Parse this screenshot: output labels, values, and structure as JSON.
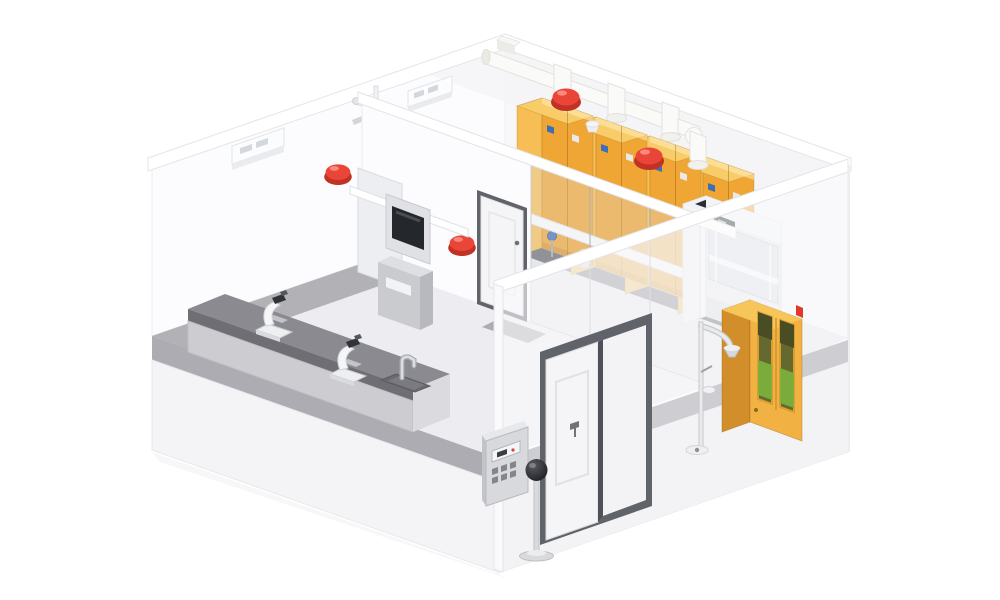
{
  "illustration": {
    "kind": "3d-isometric-cutaway-render",
    "subject": "laboratory room with ventilated hazardous-material safety cabinets",
    "background": "#ffffff",
    "objects": [
      {
        "id": "room-shell",
        "label": "White cutaway room shell with translucent walls and gray floor"
      },
      {
        "id": "ventilation-units",
        "label": "Wall-mounted white ventilation units",
        "count": 2
      },
      {
        "id": "alarm-beacons",
        "label": "Red dome alarm beacons",
        "count": 4
      },
      {
        "id": "gas-cabinet-row",
        "label": "Yellow ventilated safety storage cabinets",
        "count": 4
      },
      {
        "id": "exhaust-duct",
        "label": "White exhaust duct with risers and elbow"
      },
      {
        "id": "fume-hood",
        "label": "Fume hood with dark exhaust opening and glass sash"
      },
      {
        "id": "interior-partition",
        "label": "Interior partition with glass panels"
      },
      {
        "id": "interior-door",
        "label": "Interior single door"
      },
      {
        "id": "access-terminal",
        "label": "Access terminal with dark screen"
      },
      {
        "id": "lab-bench",
        "label": "Gray laboratory bench with sink and faucet"
      },
      {
        "id": "microscopes",
        "label": "Microscopes on bench",
        "count": 2
      },
      {
        "id": "entrance-door",
        "label": "Double entrance door with dark frame"
      },
      {
        "id": "control-panel",
        "label": "Wall-mounted control panel with buttons"
      },
      {
        "id": "globe-stand",
        "label": "Black globe sensor on floor stand"
      },
      {
        "id": "ppe-cabinet",
        "label": "Yellow emergency PPE cabinet with viewing windows"
      },
      {
        "id": "emergency-shower",
        "label": "Emergency shower with eyewash and floor drain"
      },
      {
        "id": "pipe-fittings",
        "label": "Sprinkler pipe fittings at wall junction"
      },
      {
        "id": "gas-manifold",
        "label": "White manifold pipe running across cabinets"
      }
    ],
    "colors": {
      "background": "#ffffff",
      "wall": "#F7F7FA",
      "wall-bright": "#FCFCFE",
      "ceiling": "#F4F4F7",
      "rim": "#FFFFFF",
      "floor": "#EDEDF1",
      "floor-right": "#E7E7EB",
      "floor-strip": "#9C9CA1",
      "walkway": "#5C5D63",
      "plinth": "#ACACB2",
      "base": "#F4F4F7",
      "skirt": "#C5C5CA",
      "cab-front": "#EFA634",
      "cab-side": "#F6BE55",
      "cab-top": "#F8CC68",
      "cab-trim": "#D9942E",
      "ppe-front": "#F2B243",
      "ppe-side": "#D28E2B",
      "ppe-top": "#F7C65A",
      "ppe-window": "#65682F",
      "ppe-window-dark": "#4A4C24",
      "ppe-green": "#7CB23D",
      "alarm-red": "#EA4638",
      "alarm-dark": "#C13124",
      "alarm-hi": "#FF9A8E",
      "duct": "#FAFAF8",
      "duct-edge": "#E4E2DC",
      "hood-body": "#E9EBEE",
      "hood-side": "#F3F5F7",
      "hood-top": "#F0F2F4",
      "hood-dark": "#2A2D33",
      "hood-base": "#D9DCE0",
      "hood-glass": "rgba(203,210,218,0.45)",
      "door-frame": "#60636A",
      "door-face": "#F5F5F7",
      "bench-top": "#8A8A90",
      "bench-edge": "#6E6E74",
      "bench-front": "#CDCDD1",
      "bench-end": "#DBDBDF",
      "sink": "#696A6F",
      "panel-face": "#D7D9DD",
      "panel-top": "#E6E8EB",
      "screen-dark": "#24272C",
      "metal": "#D8DADD",
      "metal-dark": "#A7AAAF",
      "globe": "#212227",
      "globe-hi": "#5A5B61",
      "blue-label": "#3D6FB4",
      "valve-blue": "#3F6FC2",
      "glass": "rgba(226,230,237,0.32)",
      "glass-frame": "rgba(172,178,186,0.55)",
      "mat": "#808187",
      "terminal-body": "#ECEEF1",
      "terminal-pedestal": "#C9CBCF"
    }
  }
}
